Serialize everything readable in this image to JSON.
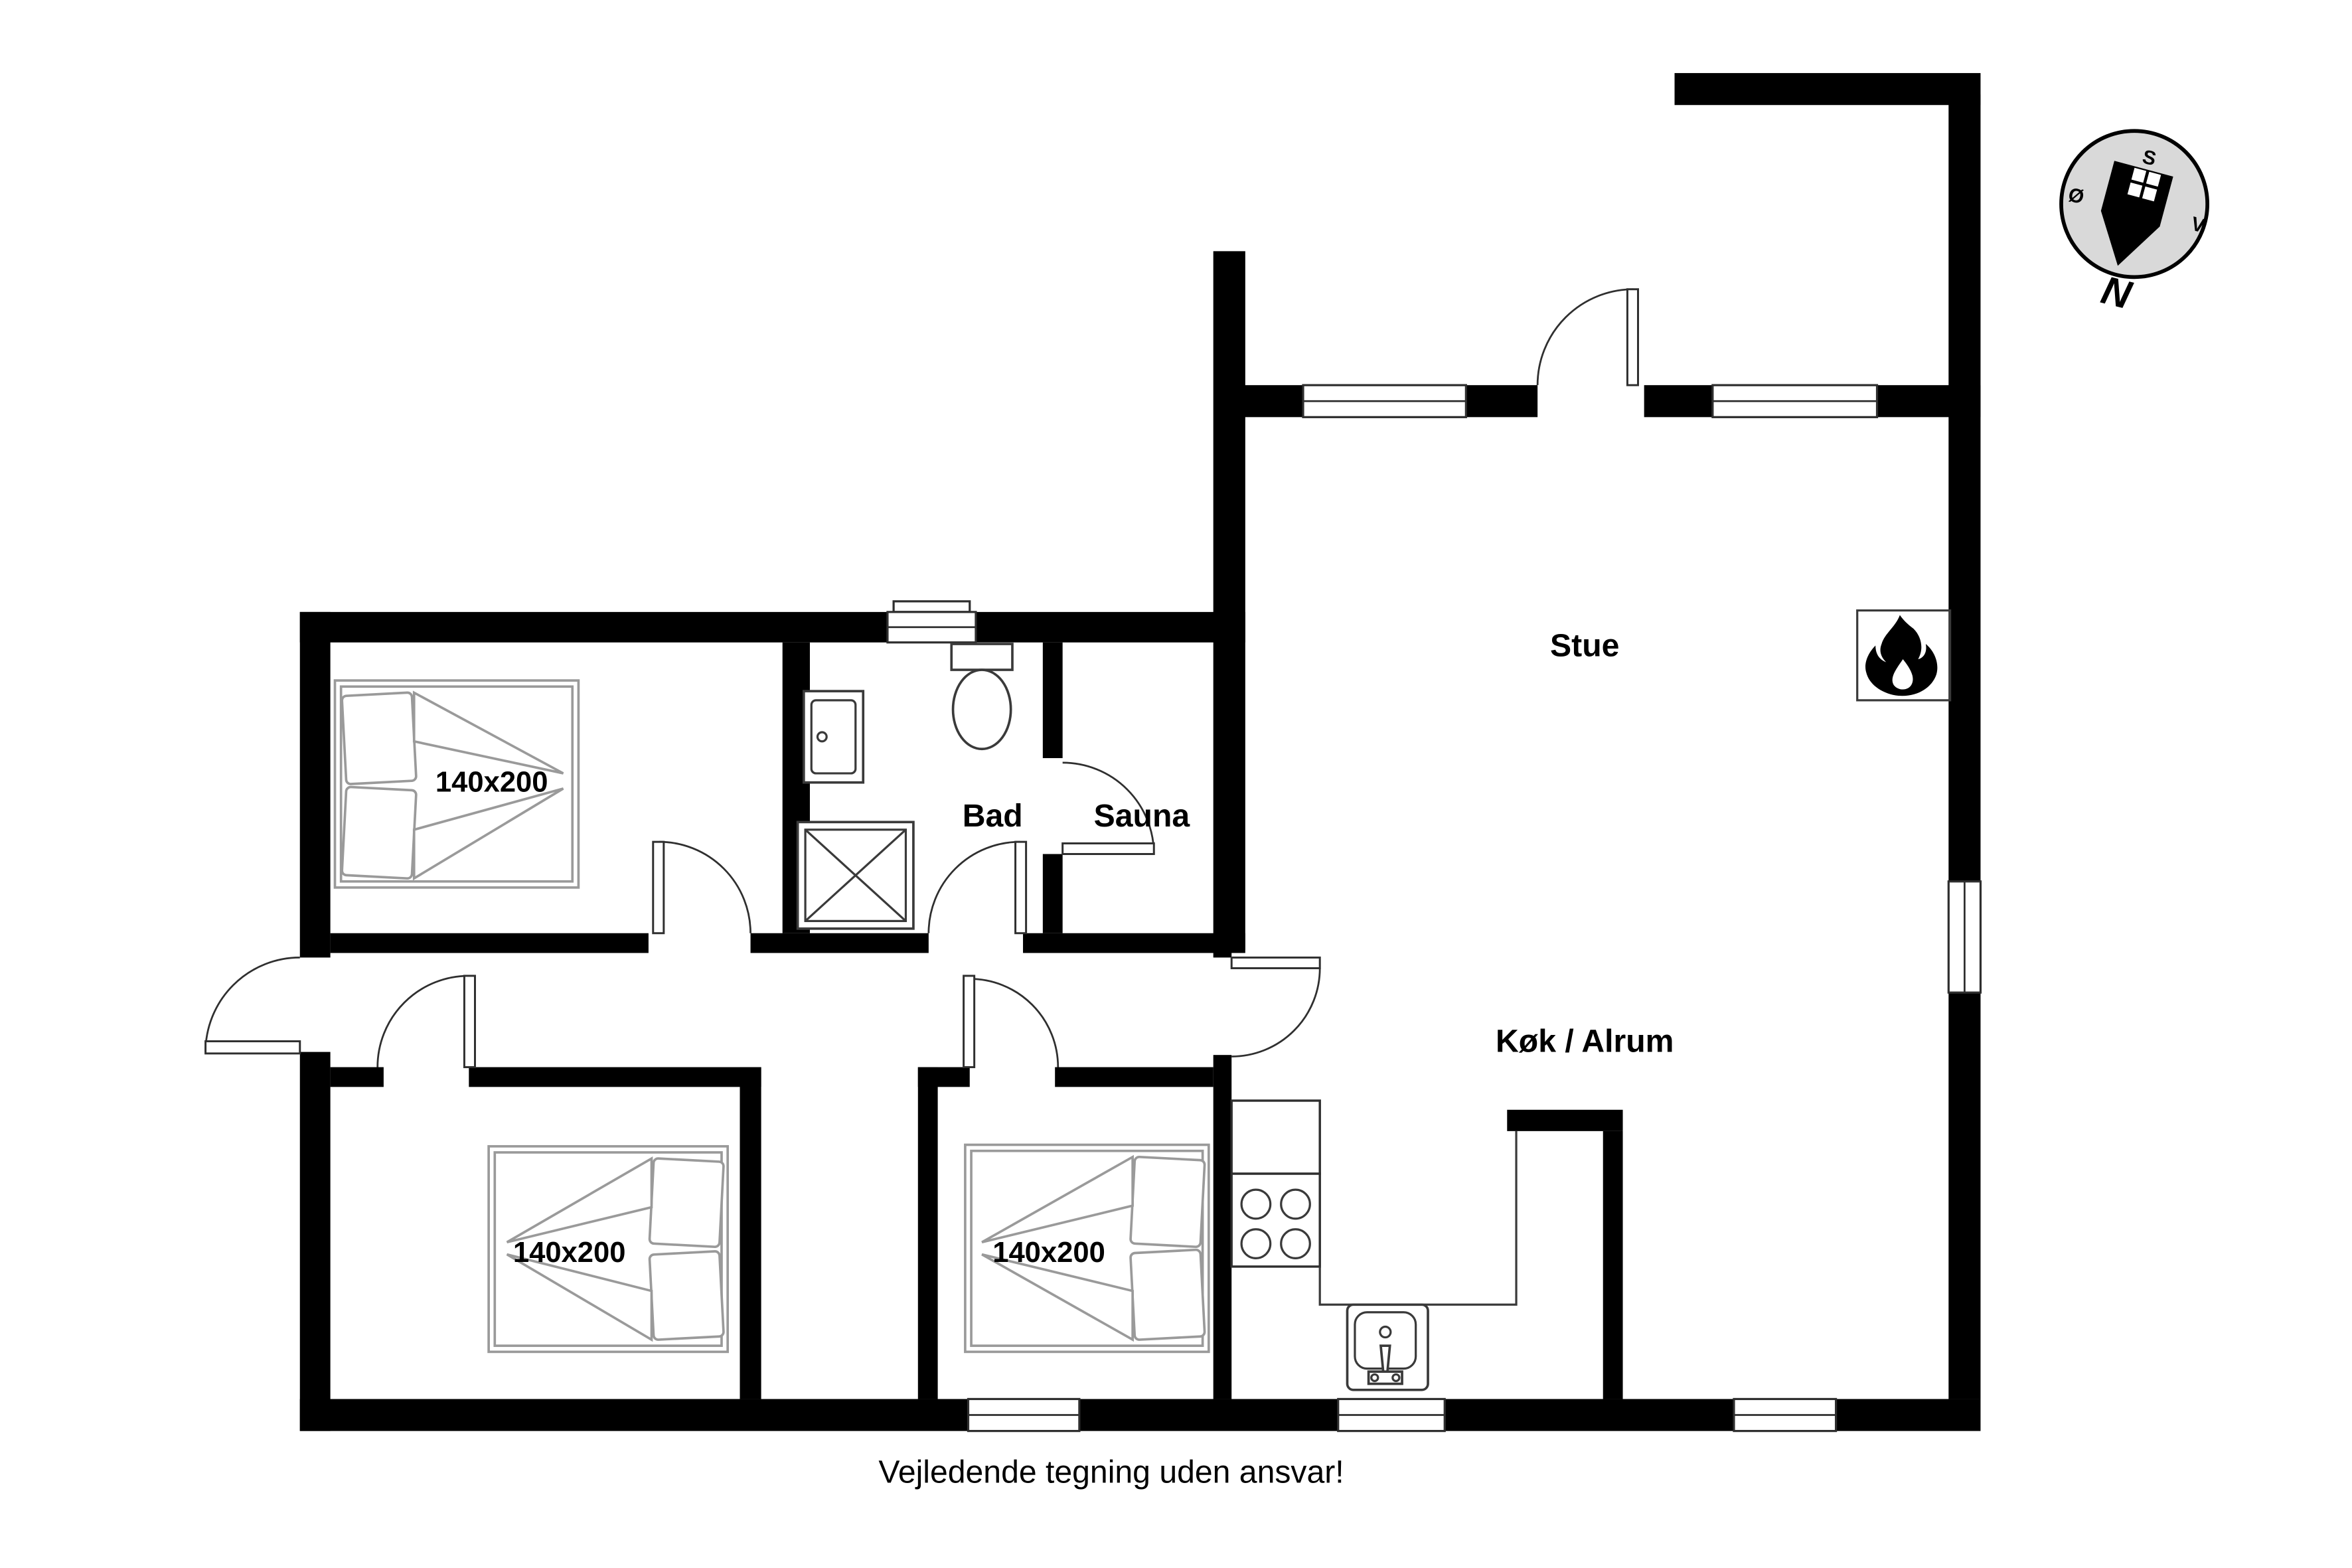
{
  "rooms": {
    "living_room": {
      "label": "Stue"
    },
    "kitchen": {
      "label": "Køk / Alrum"
    },
    "bathroom": {
      "label": "Bad"
    },
    "sauna": {
      "label": "Sauna"
    }
  },
  "beds": [
    {
      "size_label": "140x200"
    },
    {
      "size_label": "140x200"
    },
    {
      "size_label": "140x200"
    }
  ],
  "compass": {
    "n": "N",
    "s": "S",
    "e": "Ø",
    "w": "V"
  },
  "footer": {
    "disclaimer": "Vejledende tegning uden ansvar!"
  },
  "icons": {
    "fireplace": "flame-icon",
    "compass": "compass-rose-icon",
    "toilet": "toilet-icon",
    "bath_sink": "sink-icon",
    "shower": "shower-icon",
    "stove": "stove-icon",
    "kitchen_sink": "kitchen-sink-icon",
    "bed": "double-bed-icon"
  },
  "colors": {
    "walls": "#000000",
    "fixture_lines": "#3a3a3a",
    "bed_lines": "#9a9a9a",
    "compass_fill": "#d9d9d9",
    "background": "#ffffff",
    "text": "#000000"
  }
}
